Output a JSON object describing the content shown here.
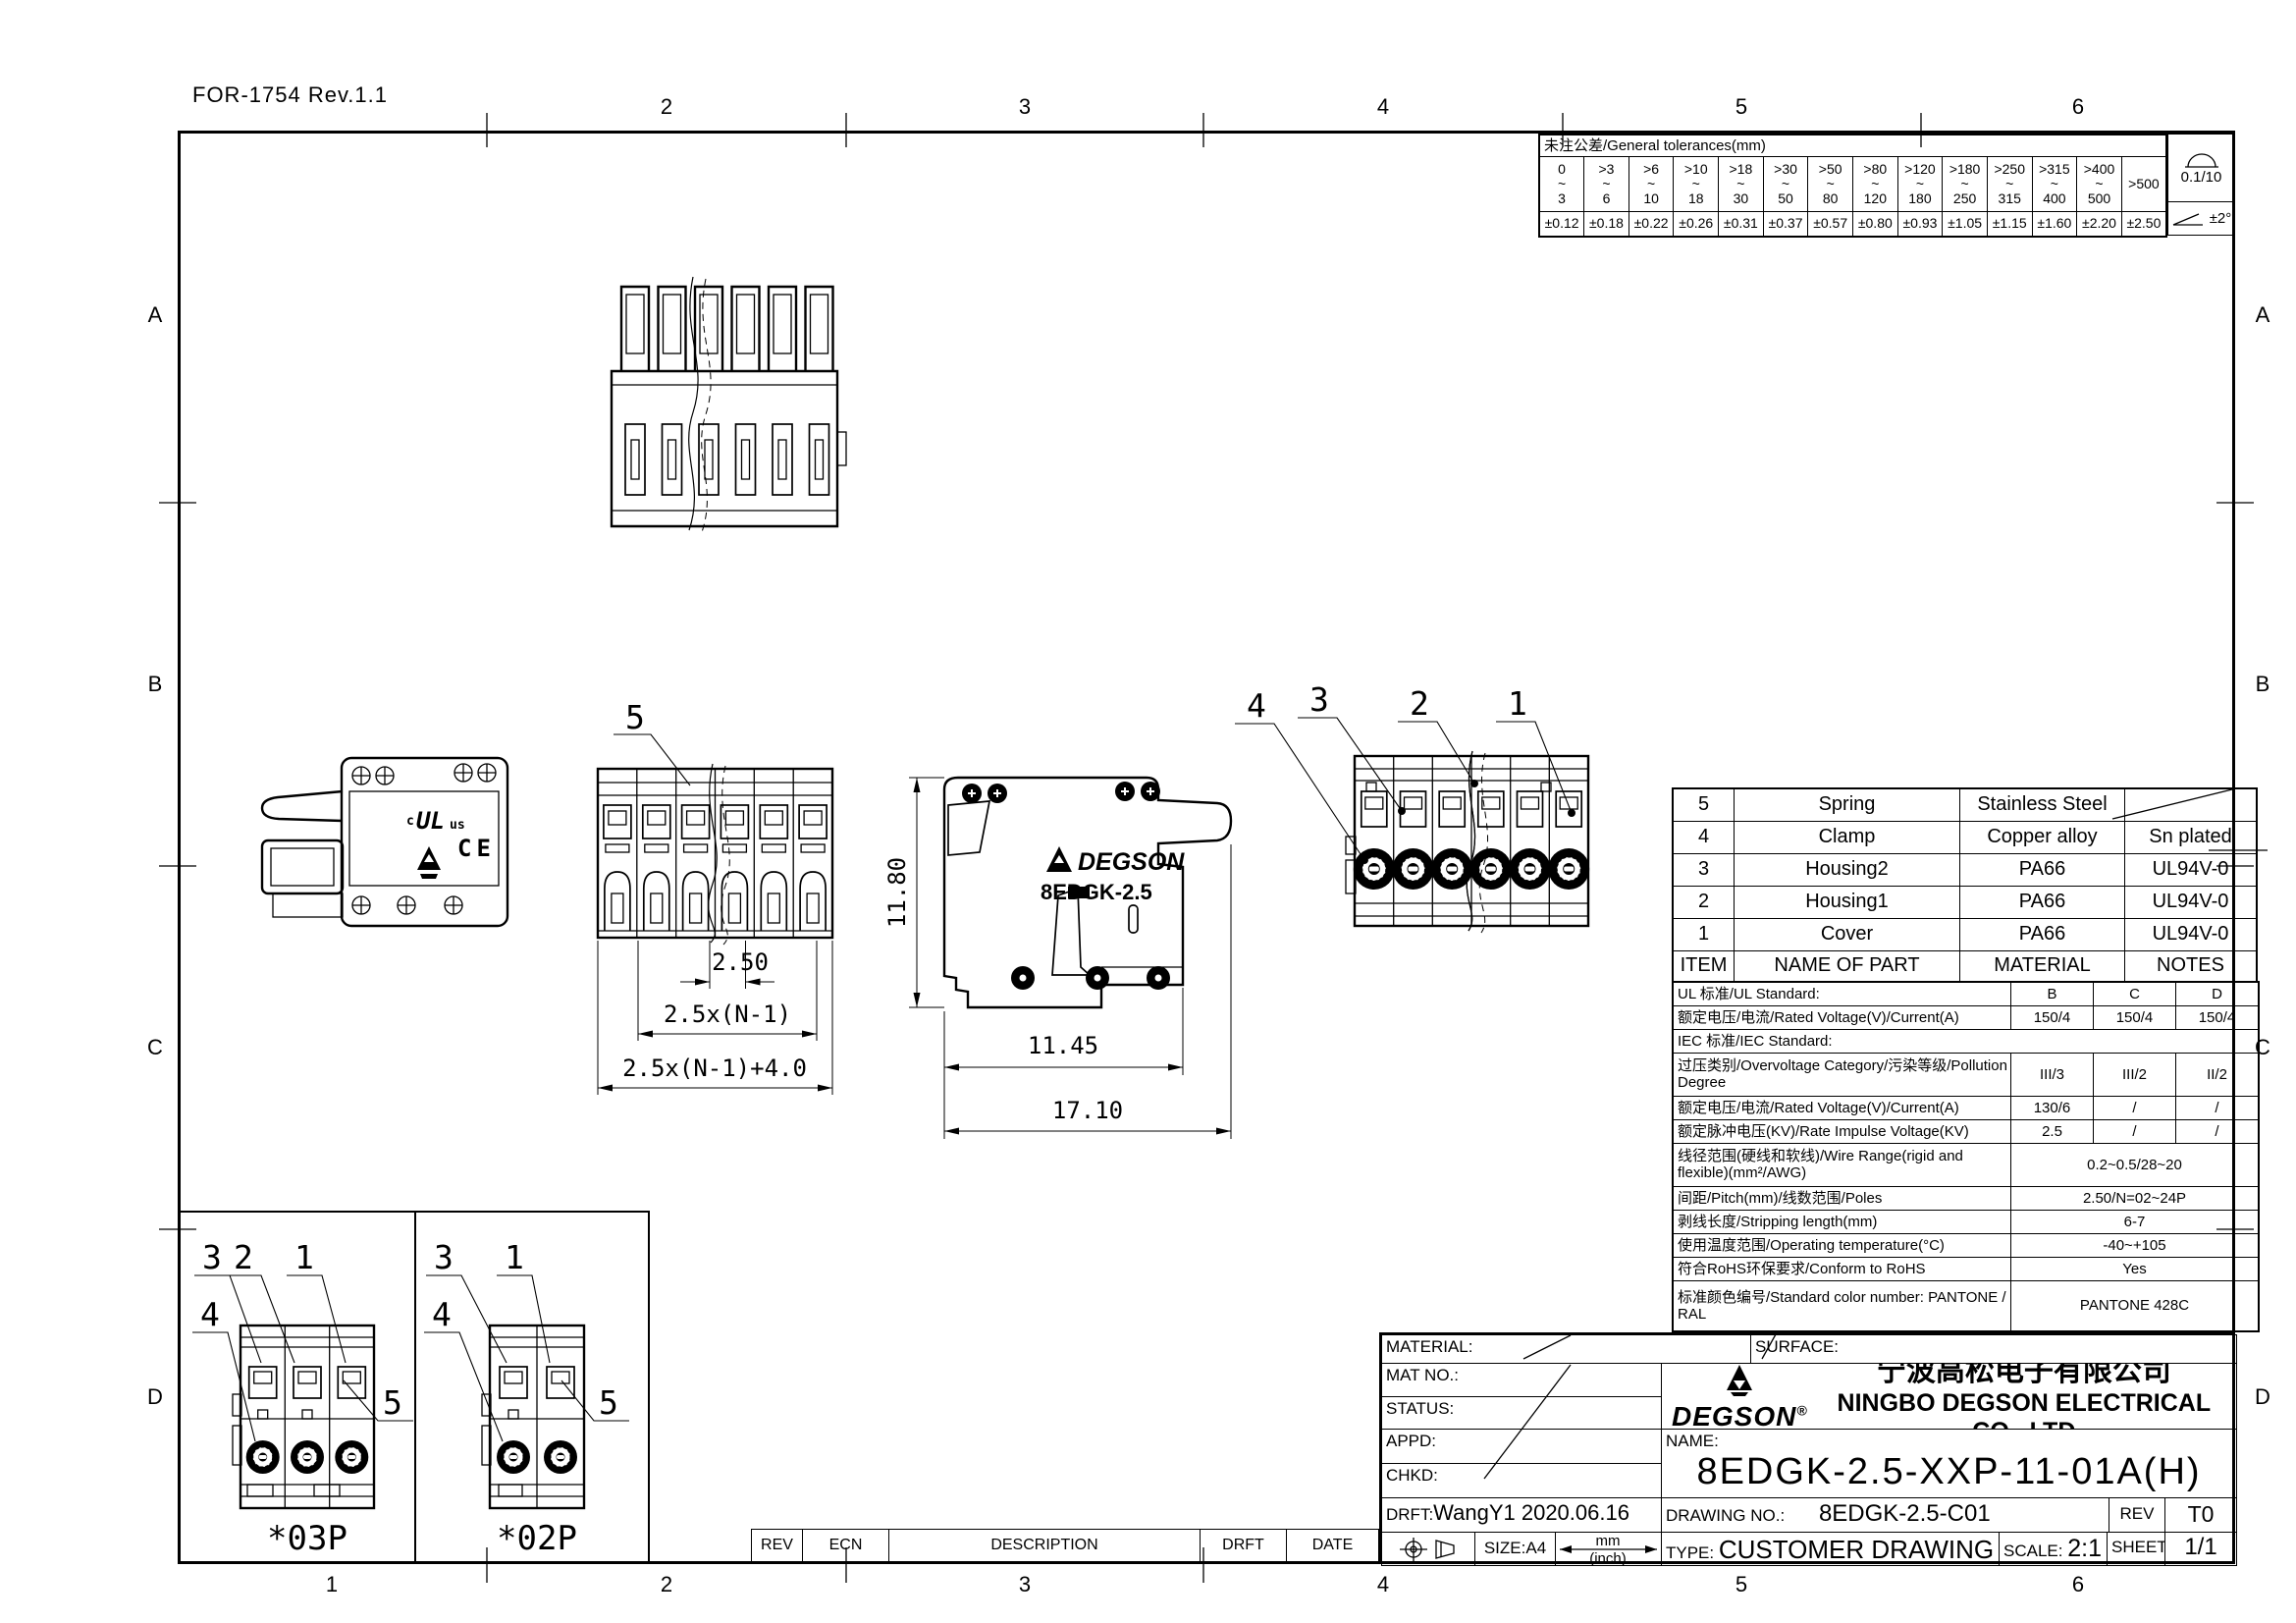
{
  "page": {
    "form_ref": "FOR-1754 Rev.1.1",
    "zones": {
      "top": [
        "2",
        "3",
        "4",
        "5",
        "6"
      ],
      "bottom": [
        "1",
        "2",
        "3",
        "4",
        "5",
        "6"
      ],
      "left": [
        "A",
        "B",
        "C",
        "D"
      ],
      "right": [
        "A",
        "B",
        "C",
        "D"
      ]
    }
  },
  "tolerance_table": {
    "title": "未注公差/General tolerances(mm)",
    "tilde": "~",
    "ranges": [
      {
        "from": "0",
        "to": "3",
        "tol": "±0.12"
      },
      {
        "from": ">3",
        "to": "6",
        "tol": "±0.18"
      },
      {
        "from": ">6",
        "to": "10",
        "tol": "±0.22"
      },
      {
        "from": ">10",
        "to": "18",
        "tol": "±0.26"
      },
      {
        "from": ">18",
        "to": "30",
        "tol": "±0.31"
      },
      {
        "from": ">30",
        "to": "50",
        "tol": "±0.37"
      },
      {
        "from": ">50",
        "to": "80",
        "tol": "±0.57"
      },
      {
        "from": ">80",
        "to": "120",
        "tol": "±0.80"
      },
      {
        "from": ">120",
        "to": "180",
        "tol": "±0.93"
      },
      {
        "from": ">180",
        "to": "250",
        "tol": "±1.05"
      },
      {
        "from": ">250",
        "to": "315",
        "tol": "±1.15"
      },
      {
        "from": ">315",
        "to": "400",
        "tol": "±1.60"
      },
      {
        "from": ">400",
        "to": "500",
        "tol": "±2.20"
      }
    ],
    "over_label": ">500",
    "over_tol": "±2.50",
    "flatness_note": "0.1/10",
    "angle_note": "±2°"
  },
  "parts_table": {
    "header": {
      "item": "ITEM",
      "name": "NAME OF PART",
      "material": "MATERIAL",
      "notes": "NOTES"
    },
    "rows": [
      {
        "item": "5",
        "name": "Spring",
        "material": "Stainless Steel",
        "notes": ""
      },
      {
        "item": "4",
        "name": "Clamp",
        "material": "Copper alloy",
        "notes": "Sn plated"
      },
      {
        "item": "3",
        "name": "Housing2",
        "material": "PA66",
        "notes": "UL94V-0"
      },
      {
        "item": "2",
        "name": "Housing1",
        "material": "PA66",
        "notes": "UL94V-0"
      },
      {
        "item": "1",
        "name": "Cover",
        "material": "PA66",
        "notes": "UL94V-0"
      }
    ]
  },
  "spec_table": {
    "ul_header": "UL 标准/UL Standard:",
    "cols": [
      "B",
      "C",
      "D"
    ],
    "ul_rated_label": "额定电压/电流/Rated Voltage(V)/Current(A)",
    "ul_rated": [
      "150/4",
      "150/4",
      "150/4"
    ],
    "iec_header": "IEC 标准/IEC Standard:",
    "overvoltage_label": "过压类别/Overvoltage Category/污染等级/Pollution Degree",
    "overvoltage": [
      "III/3",
      "III/2",
      "II/2"
    ],
    "iec_rated_label": "额定电压/电流/Rated Voltage(V)/Current(A)",
    "iec_rated": [
      "130/6",
      "/",
      "/"
    ],
    "impulse_label": "额定脉冲电压(KV)/Rate Impulse Voltage(KV)",
    "impulse": [
      "2.5",
      "/",
      "/"
    ],
    "wire_label": "线径范围(硬线和软线)/Wire Range(rigid and flexible)(mm²/AWG)",
    "wire_value": "0.2~0.5/28~20",
    "pitch_label": "间距/Pitch(mm)/线数范围/Poles",
    "pitch_value": "2.50/N=02~24P",
    "strip_label": "剥线长度/Stripping length(mm)",
    "strip_value": "6-7",
    "temp_label": "使用温度范围/Operating temperature(°C)",
    "temp_value": "-40~+105",
    "rohs_label": "符合RoHS环保要求/Conform to RoHS",
    "rohs_value": "Yes",
    "color_label": "标准颜色编号/Standard color number: PANTONE / RAL",
    "color_value": "PANTONE 428C"
  },
  "title_block": {
    "material_label": "MATERIAL:",
    "surface_label": "SURFACE:",
    "mat_no_label": "MAT NO.:",
    "status_label": "STATUS:",
    "appd_label": "APPD:",
    "chkd_label": "CHKD:",
    "drft_label": "DRFT:",
    "drft_value": "WangY1  2020.06.16",
    "drawing_no_label": "DRAWING NO.:",
    "drawing_no": "8EDGK-2.5-C01",
    "rev_label": "REV",
    "rev_value": "T0",
    "name_label": "NAME:",
    "part_name": "8EDGK-2.5-XXP-11-01A(H)",
    "logo_text": "DEGSON",
    "logo_reg": "®",
    "company_zh": "宁波高松电子有限公司",
    "company_en": "NINGBO DEGSON ELECTRICAL CO., LTD",
    "size_label": "SIZE:A4",
    "unit_top": "mm",
    "unit_bottom": "(inch)",
    "type_label": "TYPE:",
    "type_value": "CUSTOMER DRAWING",
    "scale_label": "SCALE:",
    "scale_value": "2:1",
    "sheet_label": "SHEET",
    "sheet_value": "1/1"
  },
  "revision_strip": {
    "rev": "REV",
    "ecn": "ECN",
    "description": "DESCRIPTION",
    "drft": "DRFT",
    "date": "DATE"
  },
  "views": {
    "front": {
      "callout_5": "5",
      "dim_pitch": "2.50",
      "dim_span": "2.5x(N-1)",
      "dim_total": "2.5x(N-1)+4.0"
    },
    "side": {
      "dim_height": "11.80",
      "dim_inner": "11.45",
      "dim_total": "17.10",
      "brand": "DEGSON",
      "model": "8EDGK-2.5"
    },
    "right": {
      "callout_4": "4",
      "callout_3": "3",
      "callout_2": "2",
      "callout_1": "1"
    },
    "left": {
      "ul_c": "c",
      "ul": "UL",
      "ul_us": "us",
      "ce": "CE"
    },
    "p03": {
      "label": "*03P",
      "c3": "3",
      "c2": "2",
      "c1": "1",
      "c4": "4",
      "c5": "5"
    },
    "p02": {
      "label": "*02P",
      "c3": "3",
      "c1": "1",
      "c4": "4",
      "c5": "5"
    }
  }
}
